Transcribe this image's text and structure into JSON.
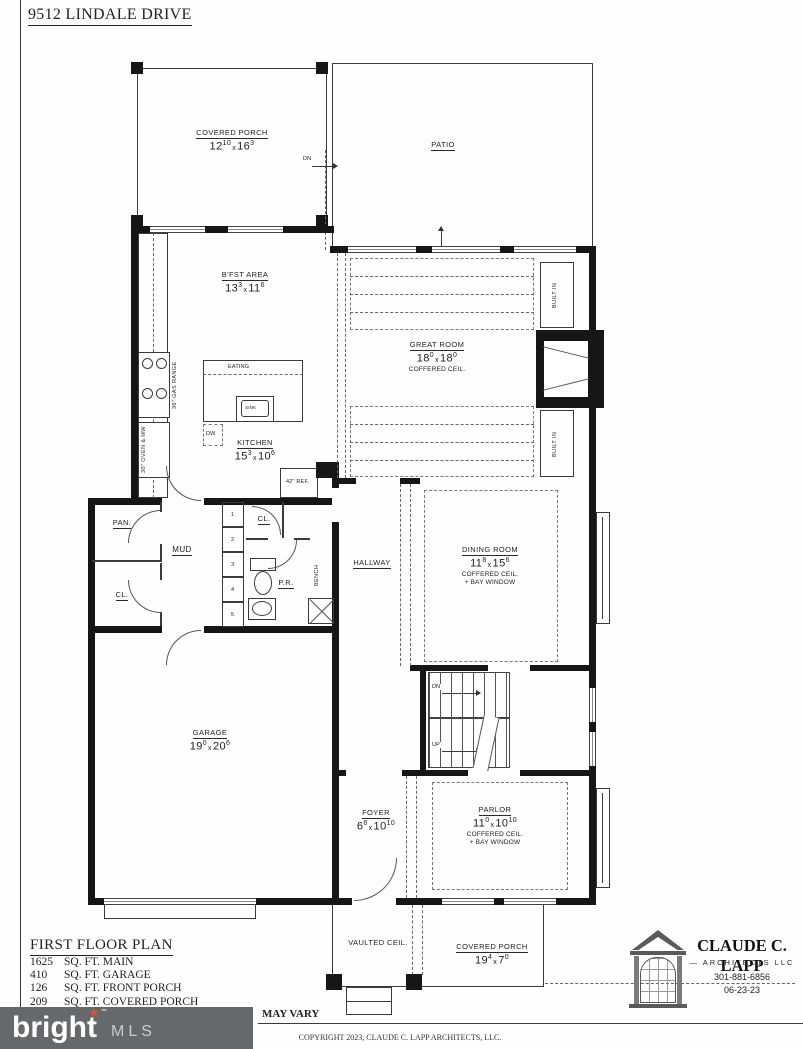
{
  "page": {
    "title": "9512 LINDALE DRIVE"
  },
  "labels": {
    "dim_x": "x"
  },
  "rooms": {
    "covered_porch_top": {
      "name": "COVERED PORCH",
      "w_ft": "12",
      "w_in": "10",
      "l_ft": "16",
      "l_in": "3"
    },
    "patio": {
      "name": "PATIO"
    },
    "bfst": {
      "name": "B'FST AREA",
      "w_ft": "13",
      "w_in": "3",
      "l_ft": "11",
      "l_in": "6"
    },
    "great_room": {
      "name": "GREAT ROOM",
      "w_ft": "18",
      "w_in": "0",
      "l_ft": "18",
      "l_in": "0",
      "note1": "COFFERED CEIL."
    },
    "kitchen": {
      "name": "KITCHEN",
      "w_ft": "15",
      "w_in": "3",
      "l_ft": "10",
      "l_in": "6"
    },
    "dining_room": {
      "name": "DINING ROOM",
      "w_ft": "11",
      "w_in": "8",
      "l_ft": "15",
      "l_in": "6",
      "note1": "COFFERED CEIL.",
      "note2": "+ BAY WINDOW"
    },
    "hallway": {
      "name": "HALLWAY"
    },
    "mud": {
      "name": "MUD"
    },
    "pantry": {
      "name": "PAN."
    },
    "closet_left": {
      "name": "CL."
    },
    "closet_small": {
      "name": "CL."
    },
    "powder": {
      "name": "P.R."
    },
    "garage": {
      "name": "GARAGE",
      "w_ft": "19",
      "w_in": "0",
      "l_ft": "20",
      "l_in": "6"
    },
    "foyer": {
      "name": "FOYER",
      "w_ft": "6",
      "w_in": "6",
      "l_ft": "10",
      "l_in": "10"
    },
    "parlor": {
      "name": "PARLOR",
      "w_ft": "11",
      "w_in": "0",
      "l_ft": "10",
      "l_in": "10",
      "note1": "COFFERED CEIL.",
      "note2": "+ BAY WINDOW"
    },
    "vaulted": {
      "name": "VAULTED CEIL."
    },
    "covered_porch_bottom": {
      "name": "COVERED PORCH",
      "w_ft": "19",
      "w_in": "4",
      "l_ft": "7",
      "l_in": "0"
    }
  },
  "fixtures": {
    "eating": "EATING",
    "sink": "SINK",
    "dw": "DW",
    "range": "36\" GAS RANGE",
    "oven": "30\" OVEN & MW",
    "ref": "42\" REF.",
    "built_in": "BUILT IN",
    "bench": "BENCH",
    "dn": "DN",
    "up": "UP"
  },
  "mud_room": {
    "cubbies": [
      "1",
      "2",
      "3",
      "4",
      "5"
    ]
  },
  "title_block": {
    "heading": "FIRST FLOOR PLAN",
    "areas": [
      {
        "value": "1625",
        "label": "SQ. FT. MAIN"
      },
      {
        "value": "410",
        "label": "SQ. FT. GARAGE"
      },
      {
        "value": "126",
        "label": "SQ. FT. FRONT PORCH"
      },
      {
        "value": "209",
        "label": "SQ. FT. COVERED PORCH"
      }
    ]
  },
  "watermark": {
    "brand": "bright",
    "suffix": "MLS",
    "note": "MAY VARY"
  },
  "architect": {
    "name": "CLAUDE C. LAPP",
    "sub": "— ARCHITECTS LLC",
    "phone": "301-881-6856",
    "date": "06-23-23"
  },
  "footer": {
    "copyright": "COPYRIGHT 2023, CLAUDE C. LAPP ARCHITECTS, LLC."
  }
}
